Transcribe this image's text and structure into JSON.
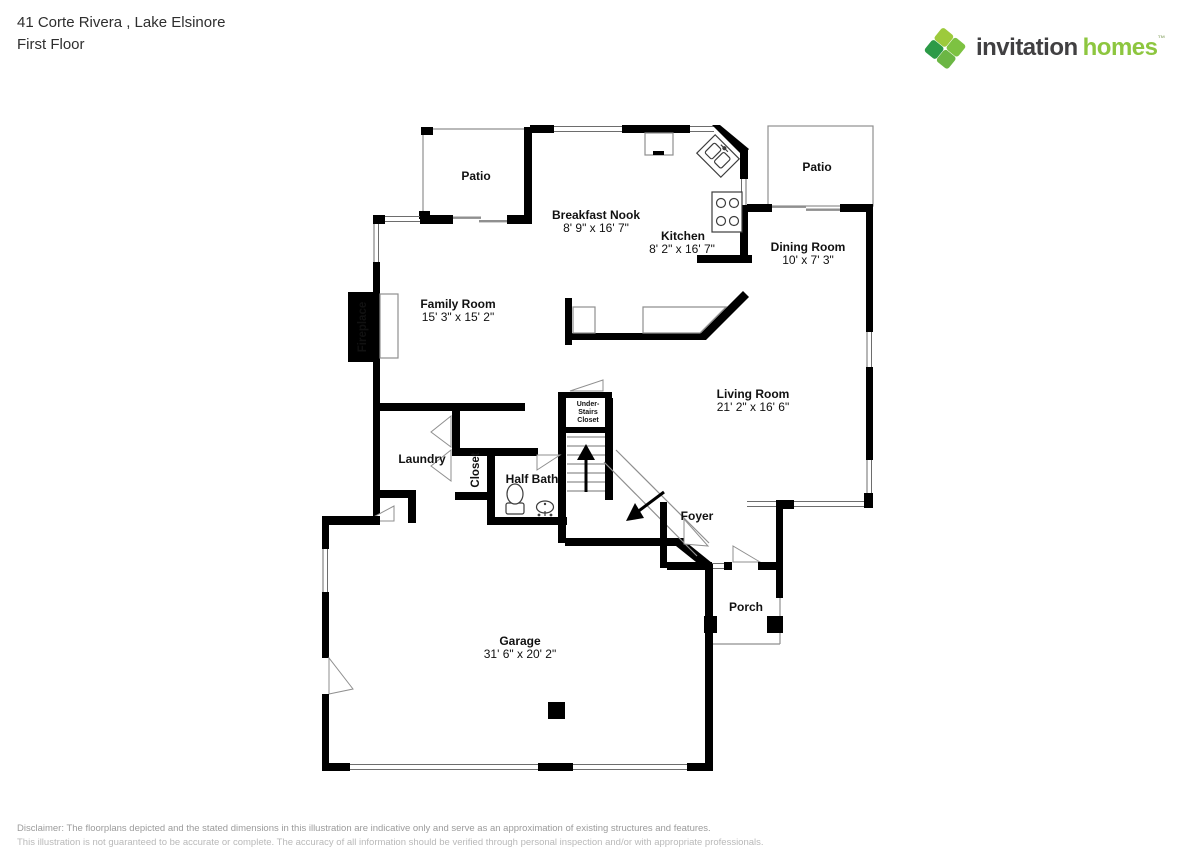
{
  "header": {
    "address": "41 Corte Rivera , Lake Elsinore",
    "floor": "First Floor"
  },
  "logo": {
    "brand_part1": "invitation",
    "brand_part2": "homes",
    "trademark": "™",
    "brand_color_dark": "#414042",
    "brand_color_green": "#8dc63f",
    "icon": "invitation-homes-leaf-icon"
  },
  "rooms": {
    "patio_left": {
      "label": "Patio"
    },
    "patio_right": {
      "label": "Patio"
    },
    "breakfast_nook": {
      "label": "Breakfast Nook",
      "dims": "8' 9\" x 16' 7\""
    },
    "kitchen": {
      "label": "Kitchen",
      "dims": "8' 2\" x 16' 7\""
    },
    "dining_room": {
      "label": "Dining Room",
      "dims": "10' x 7' 3\""
    },
    "family_room": {
      "label": "Family Room",
      "dims": "15' 3\" x 15' 2\""
    },
    "living_room": {
      "label": "Living Room",
      "dims": "21' 2\" x 16' 6\""
    },
    "laundry": {
      "label": "Laundry"
    },
    "closet": {
      "label": "Closet"
    },
    "half_bath": {
      "label": "Half Bath"
    },
    "under_stairs_closet": {
      "line1": "Under-",
      "line2": "Stairs",
      "line3": "Closet"
    },
    "foyer": {
      "label": "Foyer"
    },
    "porch": {
      "label": "Porch"
    },
    "garage": {
      "label": "Garage",
      "dims": "31' 6\" x 20' 2\""
    },
    "fireplace": {
      "label": "Fireplace"
    }
  },
  "disclaimer": {
    "line1": "Disclaimer: The floorplans depicted and the stated dimensions in this illustration are indicative only and serve as an approximation of existing structures and features.",
    "line2": "This illustration is not guaranteed to be accurate or complete. The accuracy of all information should be verified through personal inspection and/or with appropriate professionals."
  }
}
